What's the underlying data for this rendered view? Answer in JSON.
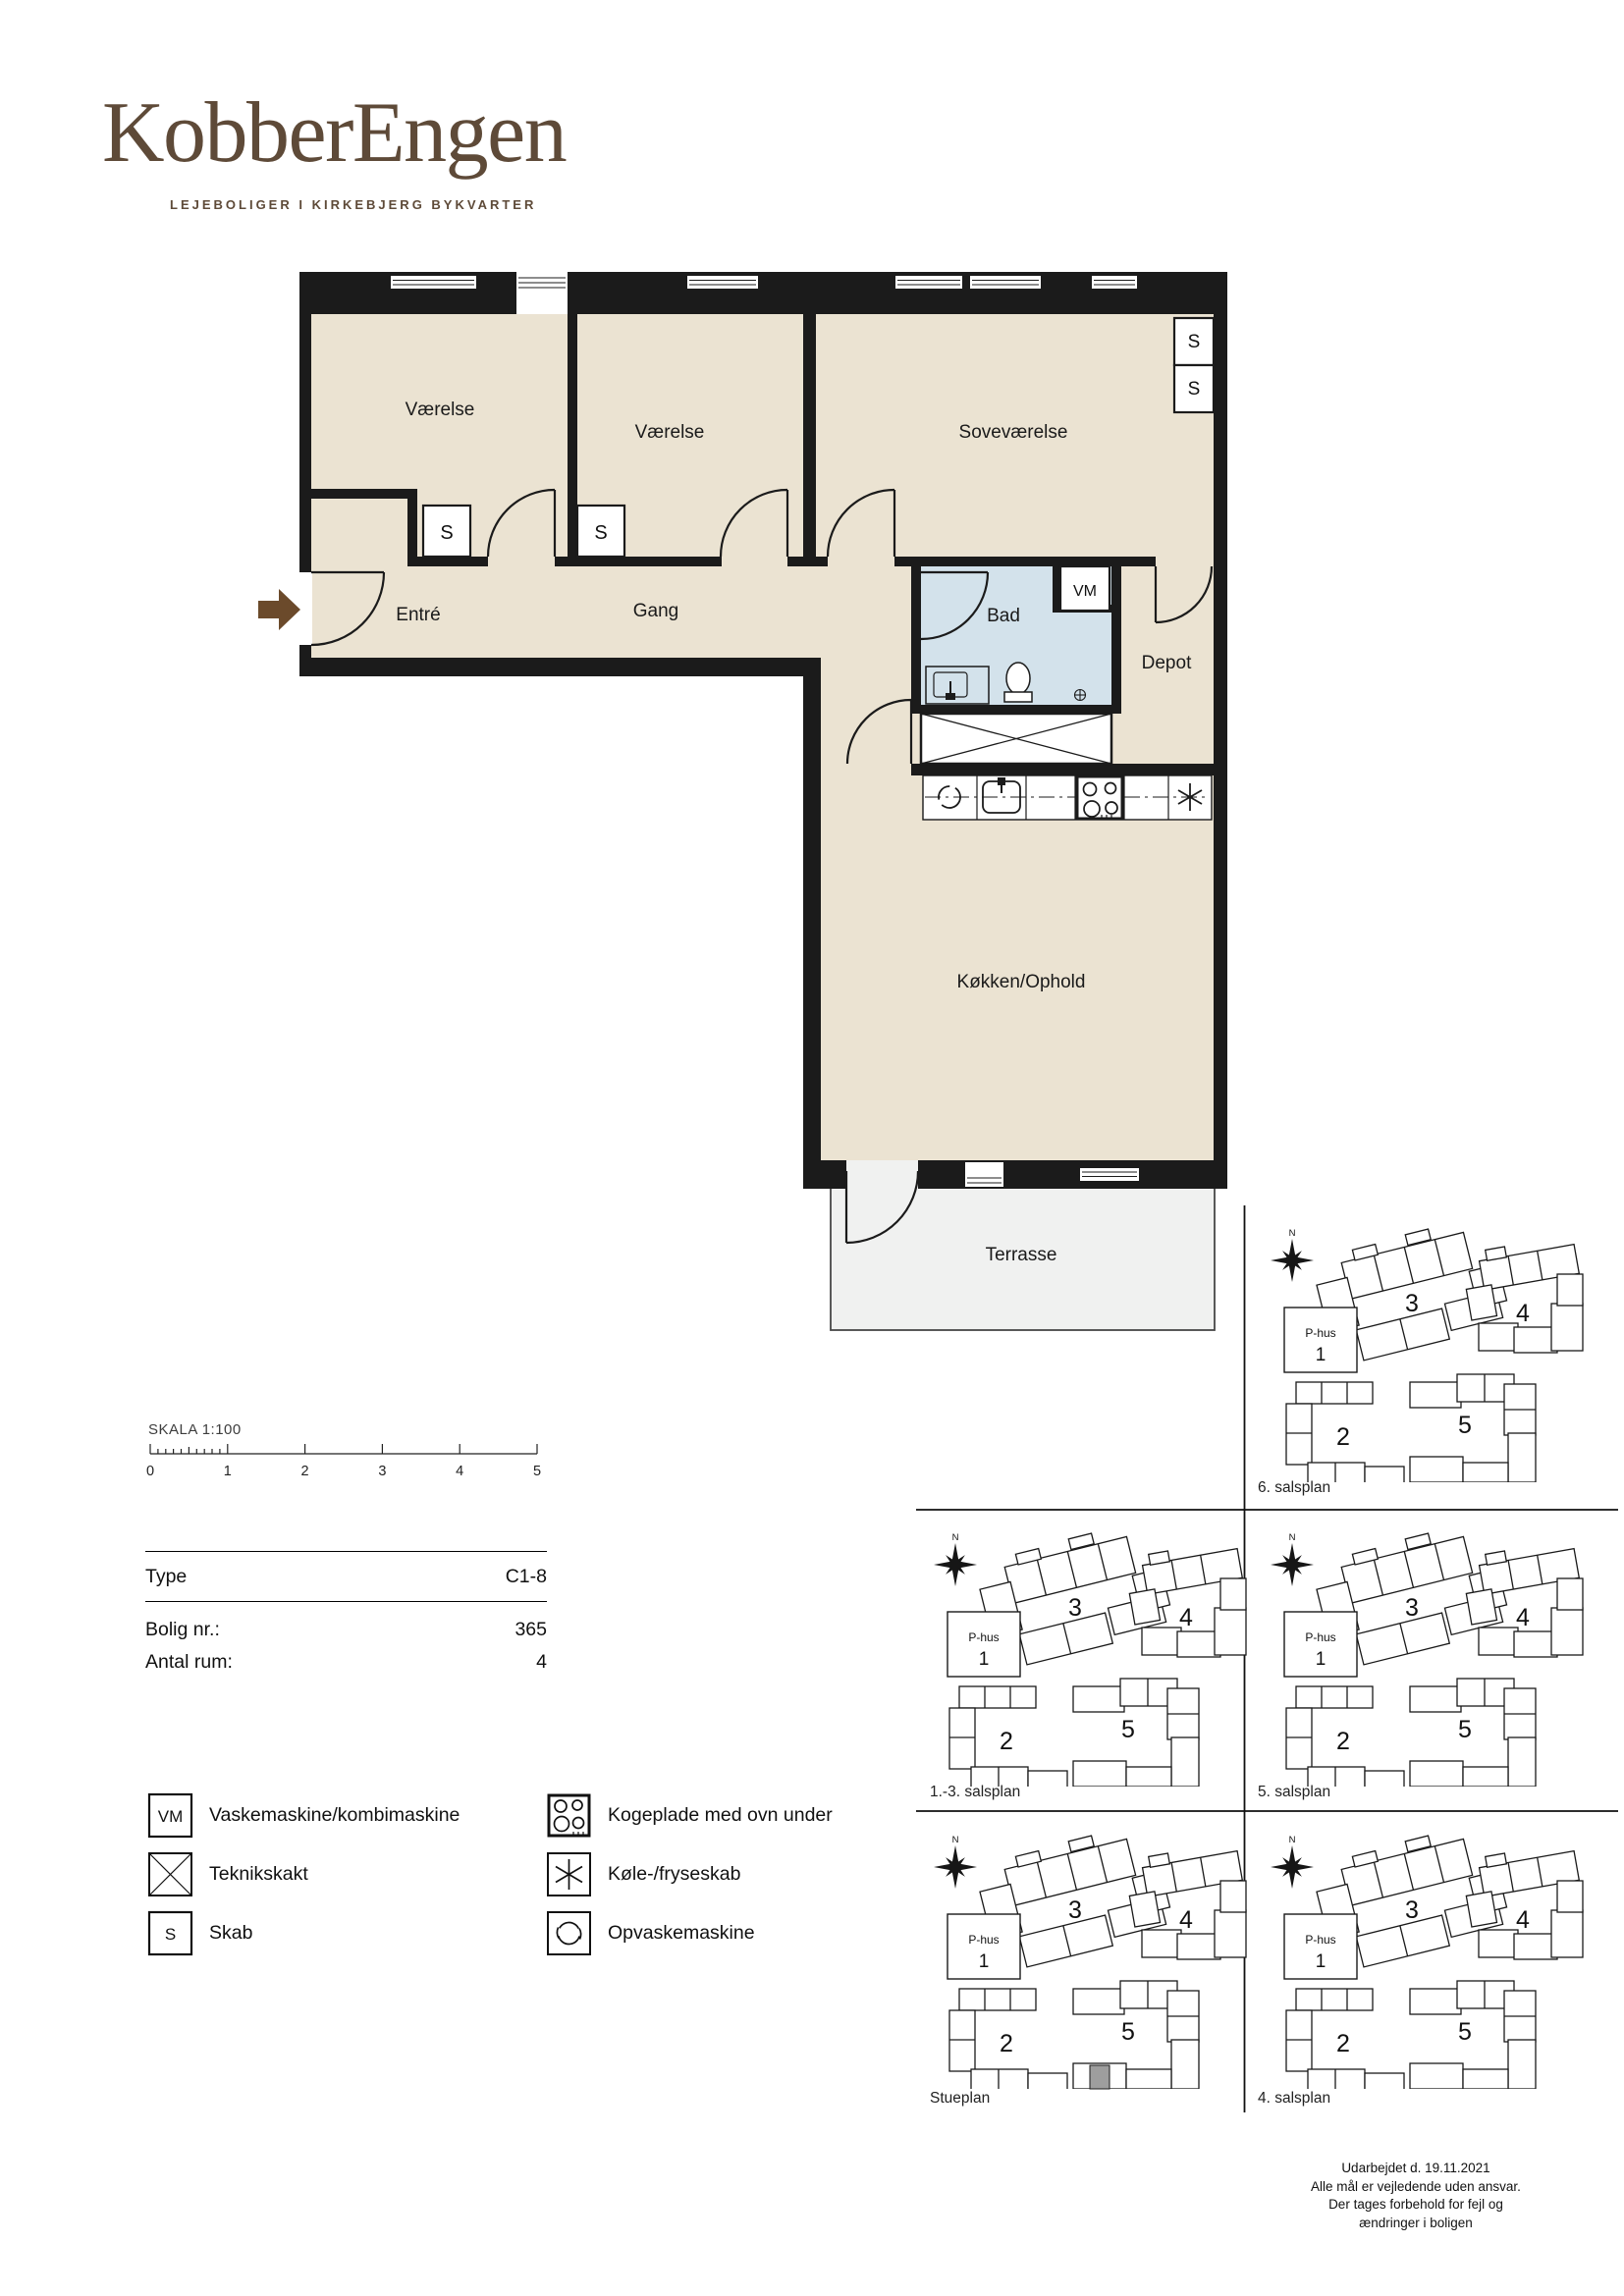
{
  "brand": {
    "logo": "KobberEngen",
    "tagline": "LEJEBOLIGER I KIRKEBJERG BYKVARTER"
  },
  "floorplan": {
    "rooms": {
      "vaerelse1": "Værelse",
      "vaerelse2": "Værelse",
      "sovevaerelse": "Soveværelse",
      "entre": "Entré",
      "gang": "Gang",
      "bad": "Bad",
      "depot": "Depot",
      "koekken": "Køkken/Ophold",
      "terrasse": "Terrasse"
    },
    "markers": {
      "closet": "S",
      "washer": "VM"
    }
  },
  "scalebar": {
    "label": "SKALA 1:100",
    "ticks": [
      "0",
      "1",
      "2",
      "3",
      "4",
      "5"
    ]
  },
  "info": {
    "rows": [
      {
        "label": "Type",
        "value": "C1-8"
      },
      {
        "label": "Bolig nr.:",
        "value": "365"
      },
      {
        "label": "Antal rum:",
        "value": "4"
      }
    ]
  },
  "legend": {
    "items": [
      {
        "icon": "vm",
        "symbol": "VM",
        "label": "Vaskemaskine/kombimaskine"
      },
      {
        "icon": "teknikskakt",
        "label": "Teknikskakt"
      },
      {
        "icon": "skab",
        "symbol": "S",
        "label": "Skab"
      },
      {
        "icon": "kogeplade",
        "label": "Kogeplade med ovn under"
      },
      {
        "icon": "koele-fryseskab",
        "label": "Køle-/fryseskab"
      },
      {
        "icon": "opvaskemaskine",
        "label": "Opvaskemaskine"
      }
    ]
  },
  "siteplans": {
    "compass": "N",
    "buildings": {
      "phus_name": "P-hus",
      "phus_num": "1",
      "b2": "2",
      "b3": "3",
      "b4": "4",
      "b5": "5"
    },
    "panels": [
      {
        "label": "6. salsplan"
      },
      {
        "label": "1.-3. salsplan"
      },
      {
        "label": "5. salsplan"
      },
      {
        "label": "Stueplan"
      },
      {
        "label": "4. salsplan"
      }
    ]
  },
  "footer": {
    "lines": [
      "Udarbejdet d. 19.11.2021",
      "Alle mål er vejledende uden ansvar.",
      "Der tages forbehold for fejl og",
      "ændringer i boligen"
    ]
  }
}
